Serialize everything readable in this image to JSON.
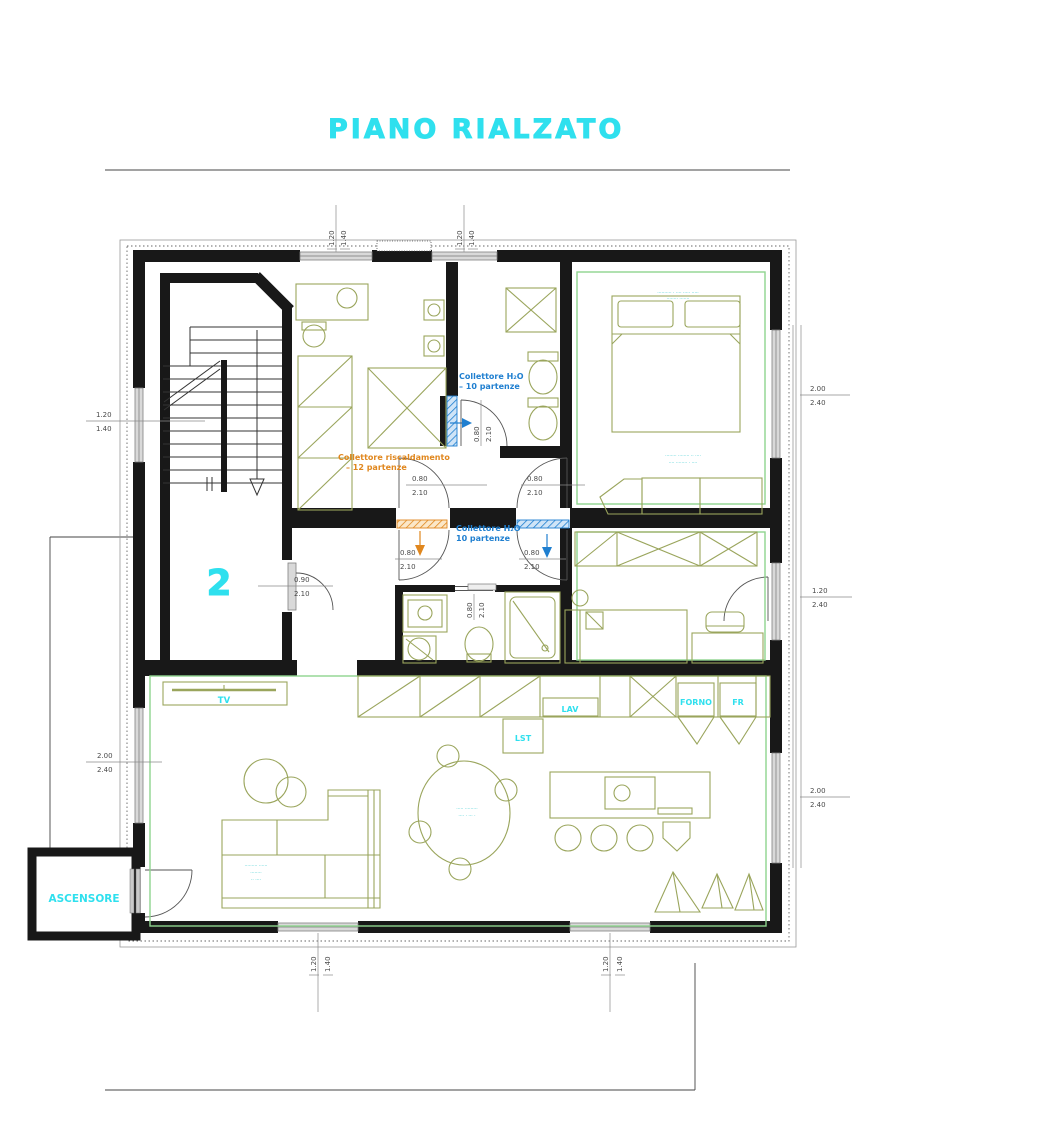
{
  "title": "PIANO RIALZATO",
  "unit_label": "2",
  "labels": {
    "elevator": "ASCENSORE",
    "tv": "TV",
    "lav": "LAV",
    "lst": "LST",
    "forno": "FORNO",
    "fr": "FR"
  },
  "collettori": {
    "h2o_top_line1": "Collettore H₂O",
    "h2o_top_line2": "– 10 partenze",
    "risc_line1": "Collettore riscaldamento",
    "risc_line2": "– 12 partenze",
    "h2o_mid_line1": "Collettore H₂O",
    "h2o_mid_line2": "10 partenze"
  },
  "dims": {
    "top_window_1": [
      "1.20",
      "1.40"
    ],
    "top_window_2": [
      "1.20",
      "1.40"
    ],
    "stair_window": [
      "1.20",
      "1.40"
    ],
    "living_window_left": [
      "2.00",
      "2.40"
    ],
    "bedroom1_window": [
      "2.00",
      "2.40"
    ],
    "bedroom2_french_door": [
      "1.20",
      "2.40"
    ],
    "living_window_right": [
      "2.00",
      "2.40"
    ],
    "bottom_window_1": [
      "1.20",
      "1.40"
    ],
    "bottom_window_2": [
      "1.20",
      "1.40"
    ],
    "door_upper_left": [
      "0.80",
      "2.10"
    ],
    "door_upper_right": [
      "0.80",
      "2.10"
    ],
    "door_lower_left": [
      "0.80",
      "2.10"
    ],
    "door_lower_right": [
      "0.80",
      "2.10"
    ],
    "entry_door": [
      "0.90",
      "2.10"
    ],
    "bath1_door": [
      "0.80",
      "2.10"
    ],
    "bath2_sliding_door": [
      "0.80",
      "2.10"
    ]
  },
  "micro_annotations": {
    "bed_note_1": "·········· · ···· ····· ·····",
    "bed_note_2": "········ ·······",
    "bench_note_1": "········ ········ ·· ····",
    "bench_note_2": "···· ········ · ····",
    "sofa_note_1": "········· ······",
    "sofa_note_2": "········",
    "sofa_note_3": "·· ····",
    "table_note_1": "····· ·········",
    "table_note_2": "···· · ··· ·"
  },
  "colors": {
    "accent_cyan": "#2fe0ee",
    "collettore_blue": "#1f7fd0",
    "collettore_orange": "#e0871e",
    "furniture_green": "#9aa55c",
    "perimeter_green": "#8fd48f",
    "wall_black": "#181818"
  }
}
